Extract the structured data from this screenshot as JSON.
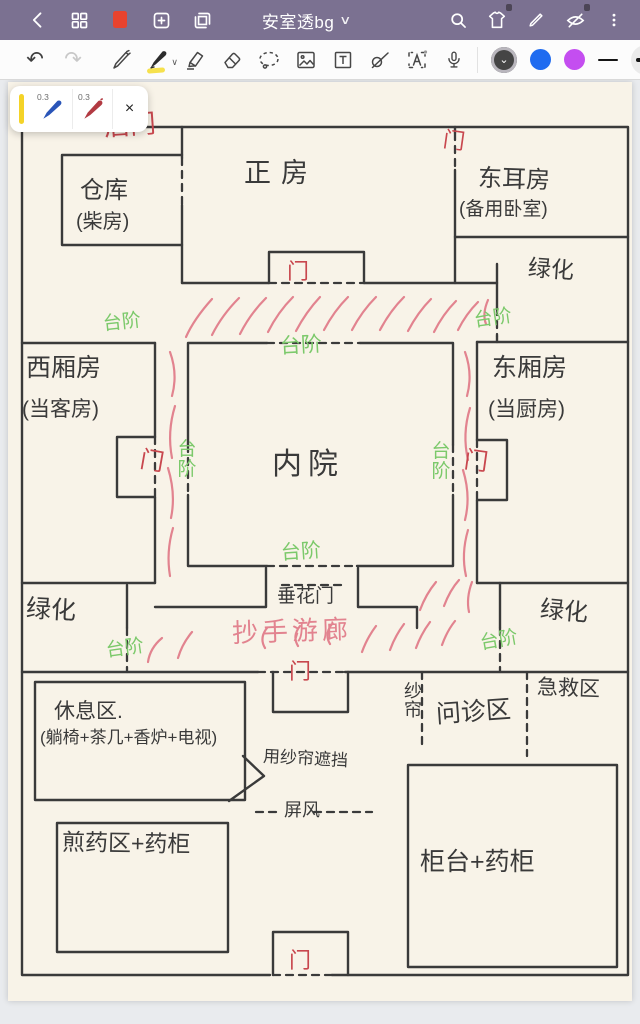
{
  "app_bar": {
    "title": "安室透bg",
    "title_chevron": "∨"
  },
  "toolbar": {
    "undo_glyph": "↶",
    "redo_glyph": "↷",
    "text_tool_letter": "T",
    "recognize_tool_letter": "A",
    "color_selected_chevron": "⌄"
  },
  "pen_popup": {
    "pens": [
      {
        "size": "0.3",
        "color": "#2a55b8"
      },
      {
        "size": "0.3",
        "color": "#b23a42"
      }
    ],
    "close_label": "×"
  },
  "colors": {
    "appbar_bg": "#7b7191",
    "accent_red_page_icon": "#e8432e",
    "ink_wall": "#3a3a3a",
    "ink_door_red": "#c8474e",
    "ink_step_green": "#7cc96b",
    "ink_corridor_pink": "#e2838f",
    "swatch_blue": "#1f6bf0",
    "swatch_purple": "#c44ef0",
    "popup_yellow": "#f4d328",
    "page_cream": "#f8f3e8"
  },
  "plan": {
    "labels": {
      "houmen": "后门",
      "zhengfang": "正房",
      "men_top": "门",
      "dongerfang": "东耳房",
      "dongerfang_sub": "(备用卧室)",
      "cangku": "仓库",
      "cangku_sub": "(柴房)",
      "lvhua_tr": "绿化",
      "men_center": "门",
      "taijie_tl": "台阶",
      "taijie_tc": "台阶",
      "taijie_tr": "台阶",
      "xixiangfang": "西厢房",
      "xixiangfang_sub": "(当客房)",
      "neiyuan": "内院",
      "dongxiangfang": "东厢房",
      "dongxiangfang_sub": "(当厨房)",
      "men_west": "门",
      "taijie_w": "台阶",
      "taijie_e": "台阶",
      "men_east": "门",
      "taijie_sc": "台阶",
      "chuihuamen": "垂花门",
      "lvhua_bl": "绿化",
      "taijie_bl": "台阶",
      "chaoshou": "抄手游廊",
      "men_mid": "门",
      "taijie_br": "台阶",
      "lvhua_br": "绿化",
      "xiuxiqu": "休息区.",
      "xiuxiqu_sub": "(躺椅+茶几+香炉+电视)",
      "yongshalian": "用纱帘遮挡",
      "pingfeng": "屏风",
      "shalian": "纱帘",
      "wenzhenqu": "问诊区",
      "jijiuqu": "急救区",
      "jianyaoqu": "煎药区+药柜",
      "guitai": "柜台+药柜",
      "men_bottom": "门"
    }
  }
}
